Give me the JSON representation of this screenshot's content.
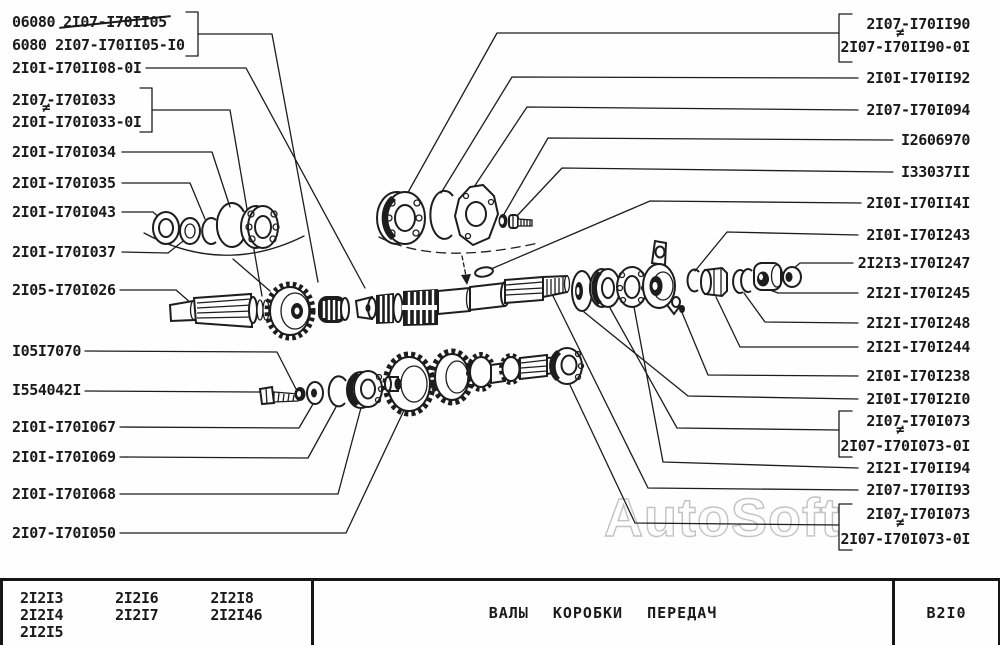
{
  "watermark": "AutoSoft",
  "mark_noninterchangeable": "≠",
  "labels": {
    "left": [
      {
        "prefix": "06080",
        "struck": "2I07-I70II05"
      },
      {
        "text": "6080 2I07-I70II05-I0"
      },
      {
        "text": "2I0I-I70II08-0I"
      },
      {
        "text": "2I07-I70I033"
      },
      {
        "text": "2I0I-I70I033-0I"
      },
      {
        "text": "2I0I-I70I034"
      },
      {
        "text": "2I0I-I70I035"
      },
      {
        "text": "2I0I-I70I043"
      },
      {
        "text": "2I0I-I70I037"
      },
      {
        "text": "2I05-I70I026"
      },
      {
        "text": "I05I7070"
      },
      {
        "text": "I554042I"
      },
      {
        "text": "2I0I-I70I067"
      },
      {
        "text": "2I0I-I70I069"
      },
      {
        "text": "2I0I-I70I068"
      },
      {
        "text": "2I07-I70I050"
      }
    ],
    "right": [
      {
        "text": "2I07-I70II90"
      },
      {
        "text": "2I07-I70II90-0I"
      },
      {
        "text": "2I0I-I70II92"
      },
      {
        "text": "2I07-I70I094"
      },
      {
        "text": "I2606970"
      },
      {
        "text": "I33037II"
      },
      {
        "text": "2I0I-I70II4I"
      },
      {
        "text": "2I0I-I70I243"
      },
      {
        "text": "2I2I3-I70I247"
      },
      {
        "text": "2I2I-I70I245"
      },
      {
        "text": "2I2I-I70I248"
      },
      {
        "text": "2I2I-I70I244"
      },
      {
        "text": "2I0I-I70I238"
      },
      {
        "text": "2I0I-I70I2I0"
      },
      {
        "text": "2I07-I70I073"
      },
      {
        "text": "2I07-I70I073-0I"
      },
      {
        "text": "2I2I-I70II94"
      },
      {
        "text": "2I07-I70II93"
      },
      {
        "text": "2I07-I70I073"
      },
      {
        "text": "2I07-I70I073-0I"
      }
    ]
  },
  "footer": {
    "model_columns": [
      [
        "2I2I3",
        "2I2I4",
        "2I2I5"
      ],
      [
        "2I2I6",
        "2I2I7"
      ],
      [
        "2I2I8",
        "2I2I46"
      ]
    ],
    "title": "ВАЛЫ КОРОБКИ ПЕРЕДАЧ",
    "sheet_code": "В2I0"
  }
}
